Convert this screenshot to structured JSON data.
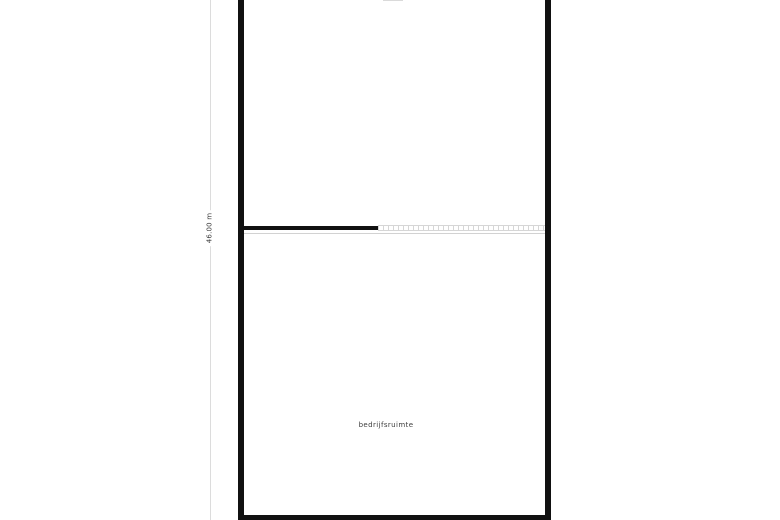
{
  "floor_plan": {
    "room_label": "bedrijfsruimte",
    "dimension_label": "46.00 m",
    "colors": {
      "background": "#ffffff",
      "wall": "#111111",
      "partition_dashed": "#d6d6d6",
      "dimension_line": "#dcdcdc",
      "label_text": "#3c3c3c"
    }
  }
}
